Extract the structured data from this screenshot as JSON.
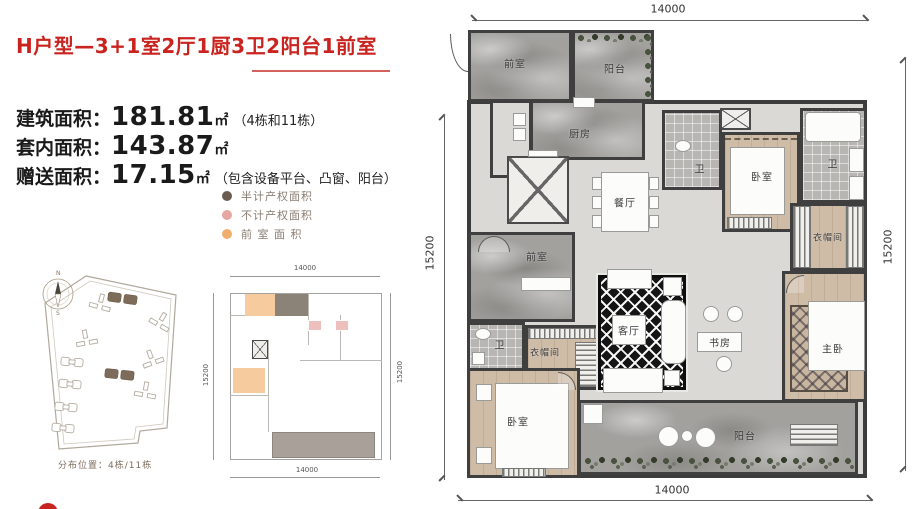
{
  "colors": {
    "accent_red": "#c9241f",
    "underline_red": "#d4625c"
  },
  "header": {
    "title": "H户型—3+1室2厅1厨3卫2阳台1前室"
  },
  "areas": {
    "line1": {
      "label": "建筑面积：",
      "value": "181.81",
      "unit": "㎡",
      "note": "（4栋和11栋）"
    },
    "line2": {
      "label": "套内面积：",
      "value": "143.87",
      "unit": "㎡",
      "note": ""
    },
    "line3": {
      "label": "赠送面积：",
      "value": "17.15",
      "unit": "㎡",
      "note": "（包含设备平台、凸窗、阳台）"
    }
  },
  "legend": {
    "items": [
      {
        "label": "半计产权面积",
        "color": "#6b5c52"
      },
      {
        "label": "不计产权面积",
        "color": "#e5a7a2"
      },
      {
        "label": "前 室 面 积",
        "color": "#f0ad6c"
      }
    ]
  },
  "siteplan": {
    "compass_north": "N",
    "compass_south": "S",
    "caption": "分布位置：4栋/11栋",
    "highlight_color": "#7d6c59"
  },
  "thumbplan": {
    "dim_top": "14000",
    "dim_bottom": "14000",
    "dim_left": "15200",
    "dim_right": "15200",
    "highlight_orange": "#f6cc9e",
    "highlight_pink": "#eec0bd",
    "highlight_dark": "#8b8378",
    "balcony_gray": "#a8a099"
  },
  "floorplan": {
    "dim_top": "14000",
    "dim_bottom": "14000",
    "dim_left": "15200",
    "dim_right": "15200",
    "rooms": {
      "front_room_top": "前室",
      "balcony_top": "阳台",
      "kitchen": "厨房",
      "dining": "餐厅",
      "bedroom_top": "卧室",
      "bath_mid": "卫",
      "bath_topright": "卫",
      "closet_right": "衣帽间",
      "front_room_mid": "前室",
      "bath_left": "卫",
      "closet_left": "衣帽间",
      "living": "客厅",
      "study": "书房",
      "master": "主卧",
      "bedroom_bottom": "卧室",
      "balcony_bottom": "阳台"
    }
  }
}
